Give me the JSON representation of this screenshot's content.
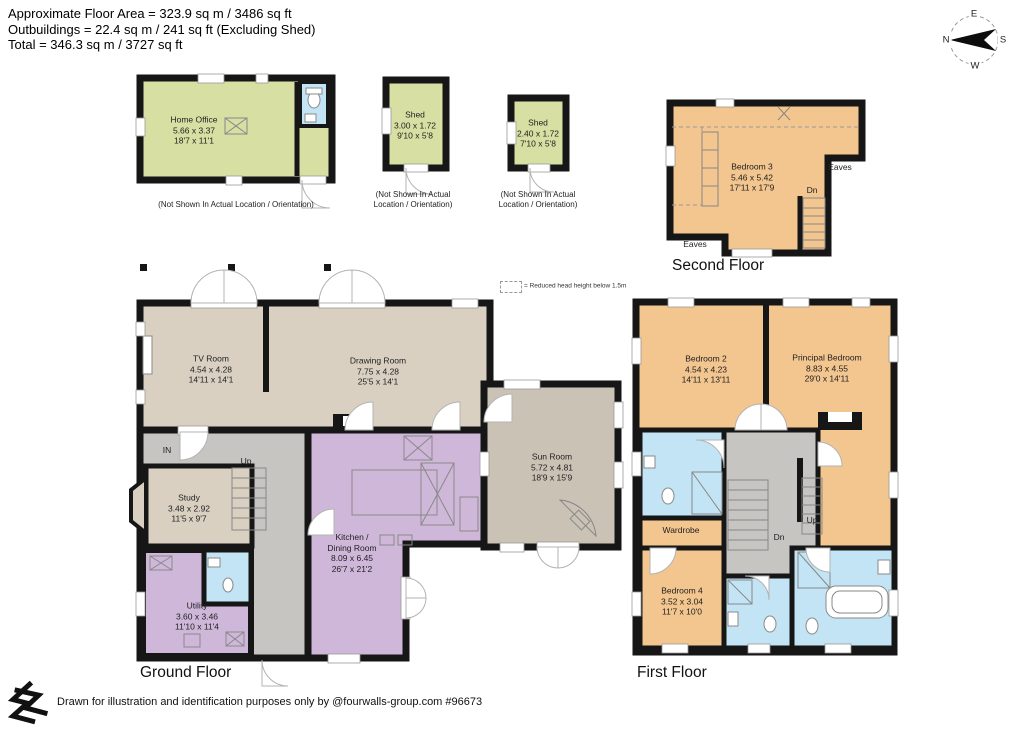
{
  "header": {
    "line1": "Approximate Floor Area = 323.9 sq m / 3486 sq ft",
    "line2": "Outbuildings = 22.4 sq m / 241 sq ft (Excluding Shed)",
    "line3": "Total = 346.3 sq m / 3727 sq ft"
  },
  "compass": {
    "north": "N",
    "east": "E",
    "south": "S",
    "west": "W"
  },
  "legend": {
    "reduced_head_height": "= Reduced head height below 1.5m"
  },
  "outbuildings": {
    "home_office": {
      "name": "Home Office",
      "dims_m": "5.66 x 3.37",
      "dims_ft": "18'7 x 11'1",
      "note": "(Not Shown In Actual Location / Orientation)"
    },
    "shed_large": {
      "name": "Shed",
      "dims_m": "3.00 x 1.72",
      "dims_ft": "9'10 x 5'8",
      "note_line1": "(Not Shown In Actual",
      "note_line2": "Location / Orientation)"
    },
    "shed_small": {
      "name": "Shed",
      "dims_m": "2.40 x 1.72",
      "dims_ft": "7'10 x 5'8",
      "note_line1": "(Not Shown In Actual",
      "note_line2": "Location / Orientation)"
    }
  },
  "floors": {
    "second": {
      "title": "Second Floor",
      "bedroom3": {
        "name": "Bedroom 3",
        "dims_m": "5.46 x 5.42",
        "dims_ft": "17'11 x 17'9"
      },
      "eaves": "Eaves",
      "dn": "Dn"
    },
    "ground": {
      "title": "Ground Floor",
      "tv_room": {
        "name": "TV Room",
        "dims_m": "4.54 x 4.28",
        "dims_ft": "14'11 x 14'1"
      },
      "drawing_room": {
        "name": "Drawing Room",
        "dims_m": "7.75 x 4.28",
        "dims_ft": "25'5 x 14'1"
      },
      "sun_room": {
        "name": "Sun Room",
        "dims_m": "5.72 x 4.81",
        "dims_ft": "18'9 x 15'9"
      },
      "study": {
        "name": "Study",
        "dims_m": "3.48 x 2.92",
        "dims_ft": "11'5 x 9'7"
      },
      "kitchen": {
        "name_line1": "Kitchen /",
        "name_line2": "Dining Room",
        "dims_m": "8.09 x 6.45",
        "dims_ft": "26'7 x 21'2"
      },
      "utility": {
        "name": "Utility",
        "dims_m": "3.60 x 3.46",
        "dims_ft": "11'10 x 11'4"
      },
      "in_label": "IN",
      "up": "Up"
    },
    "first": {
      "title": "First Floor",
      "bedroom2": {
        "name": "Bedroom 2",
        "dims_m": "4.54 x 4.23",
        "dims_ft": "14'11 x 13'11"
      },
      "principal_bedroom": {
        "name": "Principal Bedroom",
        "dims_m": "8.83 x 4.55",
        "dims_ft": "29'0 x 14'11"
      },
      "wardrobe": {
        "name": "Wardrobe"
      },
      "bedroom4": {
        "name": "Bedroom 4",
        "dims_m": "3.52 x 3.04",
        "dims_ft": "11'7 x 10'0"
      },
      "dn": "Dn",
      "up": "Up"
    }
  },
  "footer": {
    "credit": "Drawn for illustration and identification purposes only by @fourwalls-group.com #96673"
  },
  "colors": {
    "walls": "#161616",
    "reception_beige": "#d9d0c2",
    "sun_room_taupe": "#cbc2b6",
    "kitchen_purple": "#cfb7da",
    "bathroom_blue": "#c2e4f4",
    "bedroom_orange": "#f3c58f",
    "outbuilding_green": "#d8dfa3",
    "hallway_grey": "#c6c5c2"
  }
}
